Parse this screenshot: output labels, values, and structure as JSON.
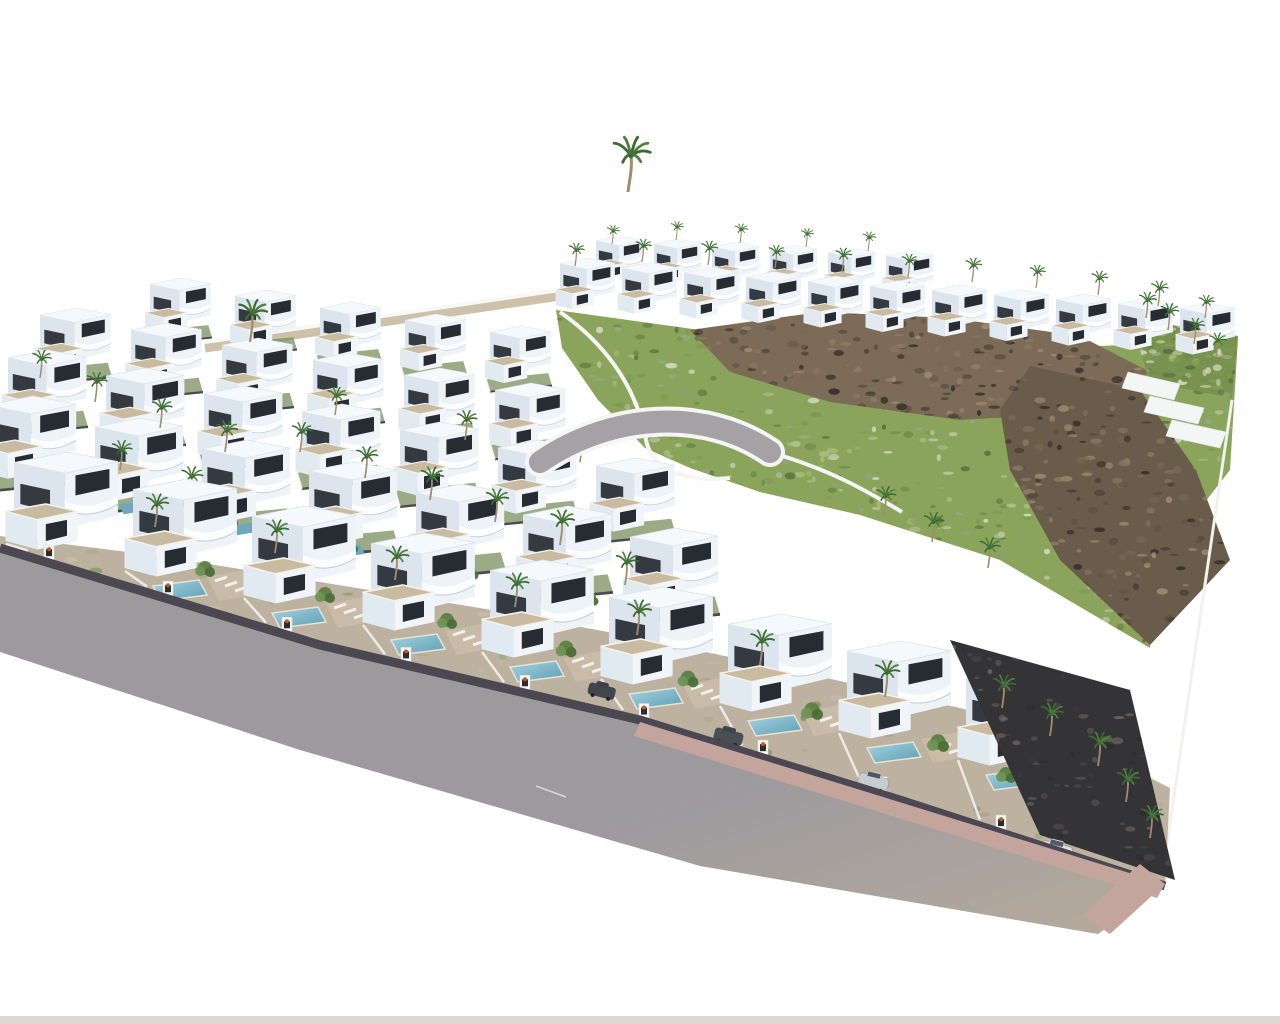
{
  "meta": {
    "title": "Aerial 3D render of a residential villa development",
    "description": "Bird's-eye architectural visualization: rows of white modern villas with gravel flat roofs, curved balconies, private pools and palm trees; a scrubby green hillside with brown rocky outcrops at the back; a grey perimeter road with pink sidewalk wrapping the front of the plot; no text or UI elements visible"
  },
  "palette": {
    "background": "#ffffff",
    "villa_front": "#eef3f8",
    "villa_side": "#dce5ee",
    "villa_top": "#f6f9fb",
    "villa_low_front": "#f1f5f9",
    "villa_low_side": "#e2eaf1",
    "roof_gravel": "#c8bba1",
    "roof_edge": "#f4f1e8",
    "window_dark": "#272c33",
    "window_side": "#333a41",
    "band_shadow": "#c3cdd6",
    "road": "#9d9a9e",
    "road_warm": "#b6aa9c",
    "sidewalk_pink": "#c4a59e",
    "wall_dark": "#4b4851",
    "pool_light": "#a5d4e0",
    "pool_deep": "#5d9db4",
    "pool_small": "#6fa8bc",
    "terrace": "#c9bca8",
    "garden_strip": "#bdb2a0",
    "garden_green": "#7a8f5d",
    "white_wall": "#f5f5f3",
    "terrain_tan": "#cdc1aa",
    "bottom_strip": "#dbd9d4",
    "curved_road": "#a5a2a6",
    "dark_gravel": "#343336",
    "hill_speckles": [
      "#7d9a4e",
      "#a9bd7b",
      "#93a98b",
      "#cfd8ba",
      "#55703c",
      "#8f9e6a",
      "#6b8a48",
      "#b7c49a"
    ],
    "rock_speckles": [
      "#7a6a55",
      "#5d5044",
      "#8d7b63",
      "#463c33",
      "#9c8a6f",
      "#35302b"
    ],
    "dark_speckles": [
      "#3a393c",
      "#2c2b2e",
      "#4a4646",
      "#565252",
      "#6a6560"
    ],
    "strip_speckles": [
      "#98a877",
      "#b3a88f",
      "#c9bca6",
      "#7e9160",
      "#a89d86"
    ],
    "palm_frond": "#4e8040",
    "palm_frond_dark": "#3c6a32",
    "palm_trunk": "#a08c6e",
    "tree_greens": [
      "#5c7f44",
      "#6f9355",
      "#4b6f38"
    ],
    "pillar_planter": "#2e2b28",
    "pillar_flower": "#c05a28",
    "lounger": "#f3f1ea"
  },
  "scene": {
    "width": 1280,
    "height": 1024,
    "terrain_strip": {
      "x1": 205,
      "y1": 348,
      "x2": 560,
      "y2": 296
    },
    "hill": {
      "points": [
        [
          556,
          310
        ],
        [
          700,
          330
        ],
        [
          860,
          345
        ],
        [
          1000,
          352
        ],
        [
          1238,
          338
        ],
        [
          1230,
          470
        ],
        [
          1160,
          560
        ],
        [
          1150,
          648
        ],
        [
          1000,
          560
        ],
        [
          860,
          515
        ],
        [
          760,
          492
        ],
        [
          690,
          468
        ],
        [
          645,
          448
        ],
        [
          598,
          400
        ],
        [
          562,
          348
        ]
      ],
      "speckles": 800,
      "seed": 11
    },
    "rock_mound": {
      "points": [
        [
          690,
          330
        ],
        [
          820,
          312
        ],
        [
          950,
          318
        ],
        [
          1080,
          336
        ],
        [
          1150,
          372
        ],
        [
          1090,
          412
        ],
        [
          960,
          420
        ],
        [
          830,
          402
        ],
        [
          730,
          372
        ]
      ],
      "speckles": 320,
      "seed": 23
    },
    "rock_right": {
      "points": [
        [
          1030,
          366
        ],
        [
          1140,
          390
        ],
        [
          1196,
          470
        ],
        [
          1230,
          560
        ],
        [
          1150,
          645
        ],
        [
          1060,
          560
        ],
        [
          1010,
          470
        ],
        [
          1000,
          410
        ]
      ],
      "speckles": 260,
      "seed": 37
    },
    "hill_wall_1": "M560,312 C600,340 636,382 646,440 C652,472 690,482 730,478",
    "hill_wall_2": "M770,452 C830,470 862,488 902,512",
    "curved_road": {
      "path": "M540,462 C612,412 706,408 770,452",
      "width": 22
    },
    "right_top_garden": {
      "points": [
        [
          1130,
          318
        ],
        [
          1238,
          336
        ],
        [
          1232,
          398
        ],
        [
          1150,
          382
        ]
      ],
      "speckles": 120,
      "seed": 51
    },
    "white_steps": [
      [
        [
          1128,
          372
        ],
        [
          1180,
          384
        ],
        [
          1174,
          400
        ],
        [
          1122,
          388
        ]
      ],
      [
        [
          1150,
          396
        ],
        [
          1204,
          408
        ],
        [
          1198,
          424
        ],
        [
          1144,
          412
        ]
      ],
      [
        [
          1172,
          420
        ],
        [
          1226,
          432
        ],
        [
          1220,
          448
        ],
        [
          1166,
          436
        ]
      ]
    ],
    "right_edge_wall": {
      "x1": 1232,
      "y1": 400,
      "x2": 1162,
      "y2": 878
    },
    "rows": [
      {
        "name": "villa-row-ridge-back",
        "x": 596,
        "y": 236,
        "dx": 58,
        "dy": 3,
        "count": 6,
        "scale": 0.48,
        "garden": "none"
      },
      {
        "name": "villa-row-ridge",
        "x": 560,
        "y": 258,
        "dx": 62,
        "dy": 4.5,
        "count": 11,
        "scale": 0.56,
        "garden": "none"
      },
      {
        "name": "villa-row-back-4",
        "x": 150,
        "y": 278,
        "dx": 85,
        "dy": 12,
        "count": 5,
        "scale": 0.62,
        "garden": "simple"
      },
      {
        "name": "villa-row-back-3",
        "x": 40,
        "y": 308,
        "dx": 91,
        "dy": 15,
        "count": 6,
        "scale": 0.72,
        "garden": "simple"
      },
      {
        "name": "villa-row-back-2",
        "x": 8,
        "y": 350,
        "dx": 98,
        "dy": 18,
        "count": 7,
        "scale": 0.8,
        "garden": "simple"
      },
      {
        "name": "villa-row-mid",
        "x": -12,
        "y": 396,
        "dx": 107,
        "dy": 22,
        "count": 7,
        "scale": 0.9,
        "garden": "simple-pool"
      },
      {
        "name": "villa-row-front",
        "x": 14,
        "y": 452,
        "dx": 119,
        "dy": 27,
        "count": 9,
        "scale": 1.06,
        "garden": "front"
      }
    ],
    "front_gardens_strip": {
      "points": [
        [
          0,
          536
        ],
        [
          160,
          556
        ],
        [
          320,
          582
        ],
        [
          480,
          608
        ],
        [
          640,
          638
        ],
        [
          800,
          672
        ],
        [
          960,
          708
        ],
        [
          1080,
          742
        ],
        [
          1170,
          788
        ],
        [
          1165,
          886
        ],
        [
          900,
          800
        ],
        [
          640,
          720
        ],
        [
          320,
          645
        ],
        [
          0,
          548
        ]
      ],
      "speckles": 240,
      "seed": 63
    },
    "road": {
      "top_pts": [
        [
          0,
          548
        ],
        [
          320,
          645
        ],
        [
          640,
          720
        ],
        [
          900,
          800
        ],
        [
          1165,
          886
        ]
      ],
      "bottom_pts": [
        [
          1098,
          934
        ],
        [
          700,
          866
        ],
        [
          300,
          750
        ],
        [
          0,
          652
        ]
      ],
      "sidewalk": [
        [
          640,
          722
        ],
        [
          1165,
          884
        ],
        [
          1157,
          898
        ],
        [
          634,
          736
        ]
      ],
      "sidewalk_corner": [
        [
          1165,
          884
        ],
        [
          1110,
          934
        ],
        [
          1082,
          915
        ],
        [
          1140,
          864
        ]
      ],
      "marking": {
        "x1": 536,
        "y1": 786,
        "x2": 566,
        "y2": 797
      }
    },
    "right_garden": {
      "points": [
        [
          950,
          640
        ],
        [
          1130,
          690
        ],
        [
          1175,
          880
        ],
        [
          1040,
          835
        ]
      ],
      "speckles": 140,
      "seed": 77
    },
    "bottom_strip": {
      "y": 1016,
      "h": 8
    },
    "palms": {
      "tall": [
        [
          628,
          192,
          1.5
        ]
      ],
      "ridge": [
        [
          575,
          266,
          0.62
        ],
        [
          642,
          262,
          0.62
        ],
        [
          708,
          265,
          0.65
        ],
        [
          775,
          268,
          0.62
        ],
        [
          842,
          272,
          0.65
        ],
        [
          908,
          277,
          0.62
        ],
        [
          972,
          282,
          0.65
        ],
        [
          1036,
          288,
          0.62
        ],
        [
          1098,
          295,
          0.65
        ],
        [
          1158,
          306,
          0.68
        ],
        [
          1205,
          318,
          0.62
        ]
      ],
      "ridge_back": [
        [
          612,
          244,
          0.5
        ],
        [
          676,
          240,
          0.5
        ],
        [
          740,
          243,
          0.52
        ],
        [
          806,
          247,
          0.5
        ],
        [
          868,
          251,
          0.52
        ]
      ],
      "right_top": [
        [
          1146,
          318,
          0.7
        ],
        [
          1168,
          330,
          0.72
        ],
        [
          1194,
          344,
          0.7
        ],
        [
          1216,
          358,
          0.68
        ]
      ],
      "left_block": [
        [
          250,
          342,
          1.15
        ],
        [
          40,
          378,
          0.75
        ],
        [
          95,
          402,
          0.8
        ],
        [
          335,
          415,
          0.75
        ],
        [
          160,
          428,
          0.8
        ],
        [
          465,
          440,
          0.8
        ],
        [
          225,
          452,
          0.85
        ],
        [
          300,
          452,
          0.8
        ],
        [
          580,
          462,
          0.8
        ],
        [
          120,
          470,
          0.8
        ],
        [
          365,
          478,
          0.85
        ],
        [
          190,
          498,
          0.85
        ],
        [
          430,
          500,
          0.9
        ],
        [
          495,
          522,
          0.9
        ],
        [
          560,
          545,
          0.95
        ],
        [
          625,
          585,
          0.9
        ]
      ],
      "hill_base": [
        [
          884,
          516,
          0.8
        ],
        [
          932,
          542,
          0.8
        ],
        [
          988,
          568,
          0.82
        ]
      ],
      "front": [
        [
          155,
          527,
          0.9
        ],
        [
          275,
          553,
          0.9
        ],
        [
          395,
          580,
          0.92
        ],
        [
          515,
          607,
          0.92
        ],
        [
          637,
          635,
          0.95
        ],
        [
          760,
          665,
          0.95
        ],
        [
          885,
          697,
          0.98
        ],
        [
          1010,
          732,
          0.98
        ]
      ],
      "right_garden": [
        [
          1002,
          708,
          0.9
        ],
        [
          1050,
          736,
          0.9
        ],
        [
          1098,
          766,
          0.92
        ],
        [
          1126,
          802,
          0.9
        ],
        [
          1150,
          838,
          0.88
        ]
      ]
    },
    "trees": {
      "front": [
        [
          205,
          568,
          1
        ],
        [
          325,
          594,
          1
        ],
        [
          447,
          620,
          1
        ],
        [
          566,
          648,
          1.05
        ],
        [
          688,
          678,
          1.05
        ],
        [
          812,
          710,
          1.1
        ],
        [
          938,
          742,
          1.1
        ],
        [
          1006,
          774,
          1
        ]
      ],
      "mid": [
        [
          230,
          520,
          0.8
        ],
        [
          350,
          546,
          0.8
        ],
        [
          470,
          572,
          0.85
        ],
        [
          590,
          598,
          0.85
        ]
      ]
    },
    "cars": [
      {
        "x": 590,
        "y": 682,
        "s": 0.8,
        "c": "#41464d"
      },
      {
        "x": 716,
        "y": 727,
        "s": 0.85,
        "c": "#4a4f55"
      },
      {
        "x": 860,
        "y": 772,
        "s": 0.9,
        "c": "#c7ccd1"
      },
      {
        "x": 1042,
        "y": 840,
        "s": 0.95,
        "c": "#dde1e4"
      },
      {
        "x": 1088,
        "y": 864,
        "s": 0.95,
        "c": "#eceeef"
      }
    ]
  }
}
